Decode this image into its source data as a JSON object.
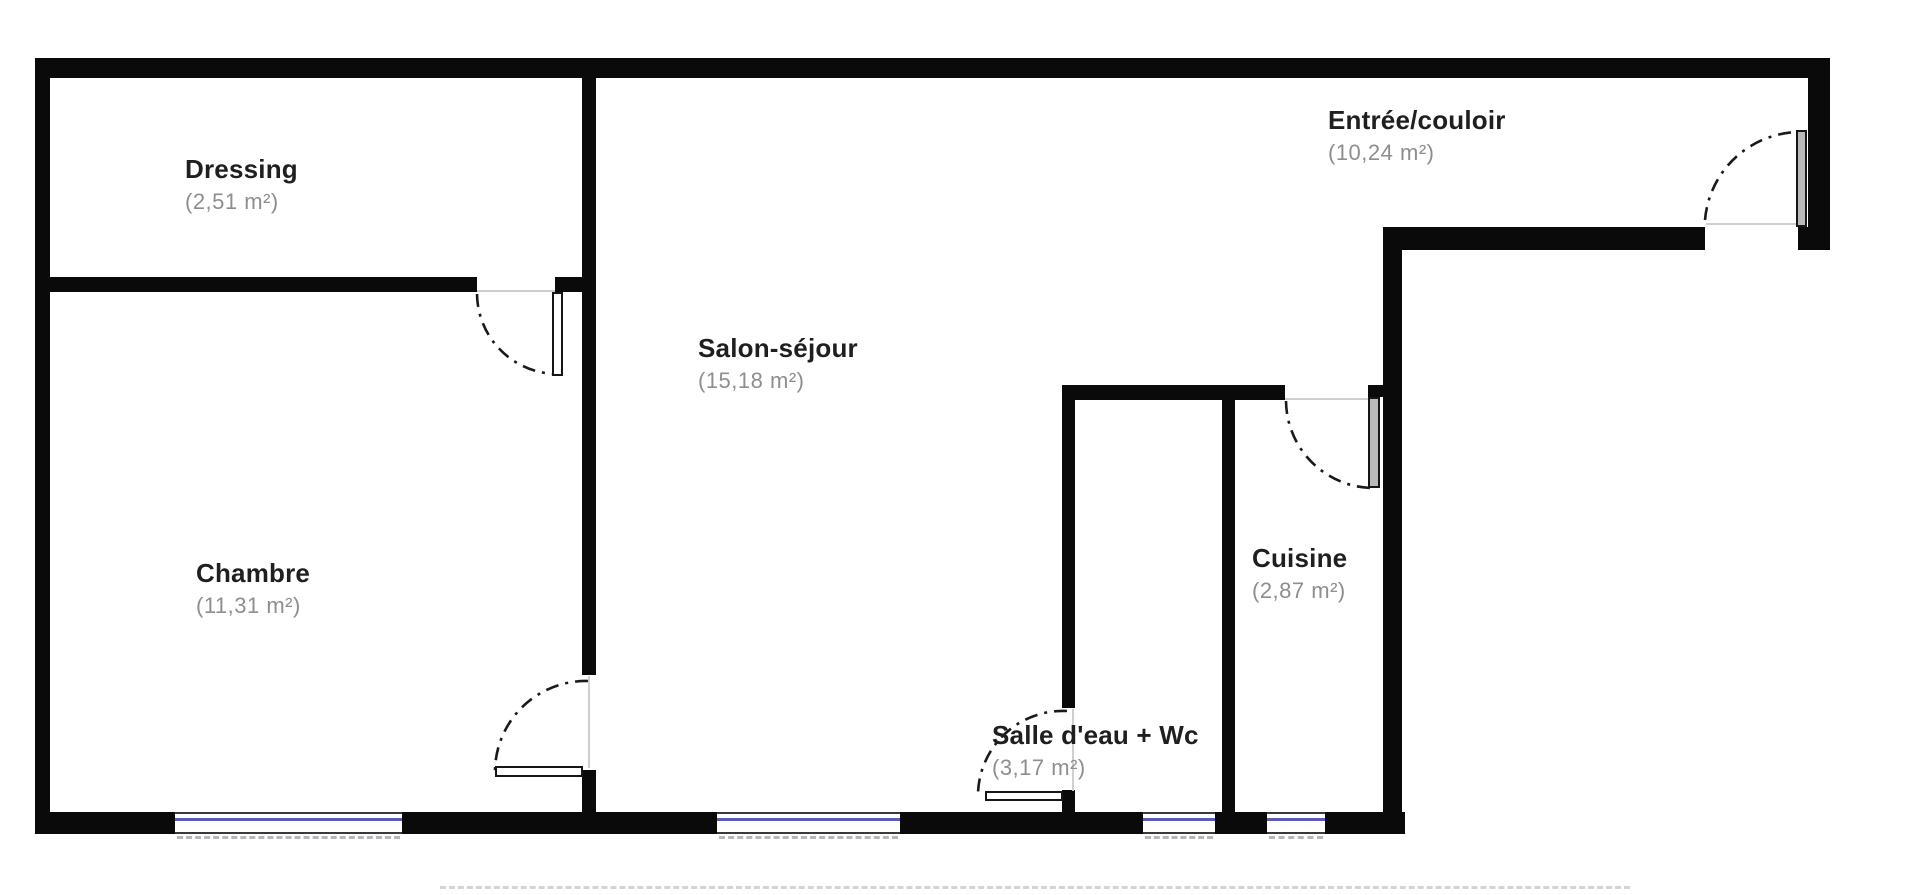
{
  "plan": {
    "type": "apartment-floor-plan",
    "colors": {
      "wall": "#0a0a0a",
      "window_glass": "#5b5bb5",
      "room_name_text": "#1f1f1f",
      "room_area_text": "#8e8e8e",
      "door_swing_line": "#1a1a1a"
    },
    "rooms": {
      "dressing": {
        "name": "Dressing",
        "area": "(2,51 m²)"
      },
      "chambre": {
        "name": "Chambre",
        "area": "(11,31 m²)"
      },
      "salon": {
        "name": "Salon-séjour",
        "area": "(15,18 m²)"
      },
      "salle_eau": {
        "name": "Salle d'eau + Wc",
        "area": "(3,17 m²)"
      },
      "cuisine": {
        "name": "Cuisine",
        "area": "(2,87 m²)"
      },
      "entree": {
        "name": "Entrée/couloir",
        "area": "(10,24 m²)"
      }
    },
    "counts": {
      "windows": 4,
      "doors": 5
    }
  }
}
